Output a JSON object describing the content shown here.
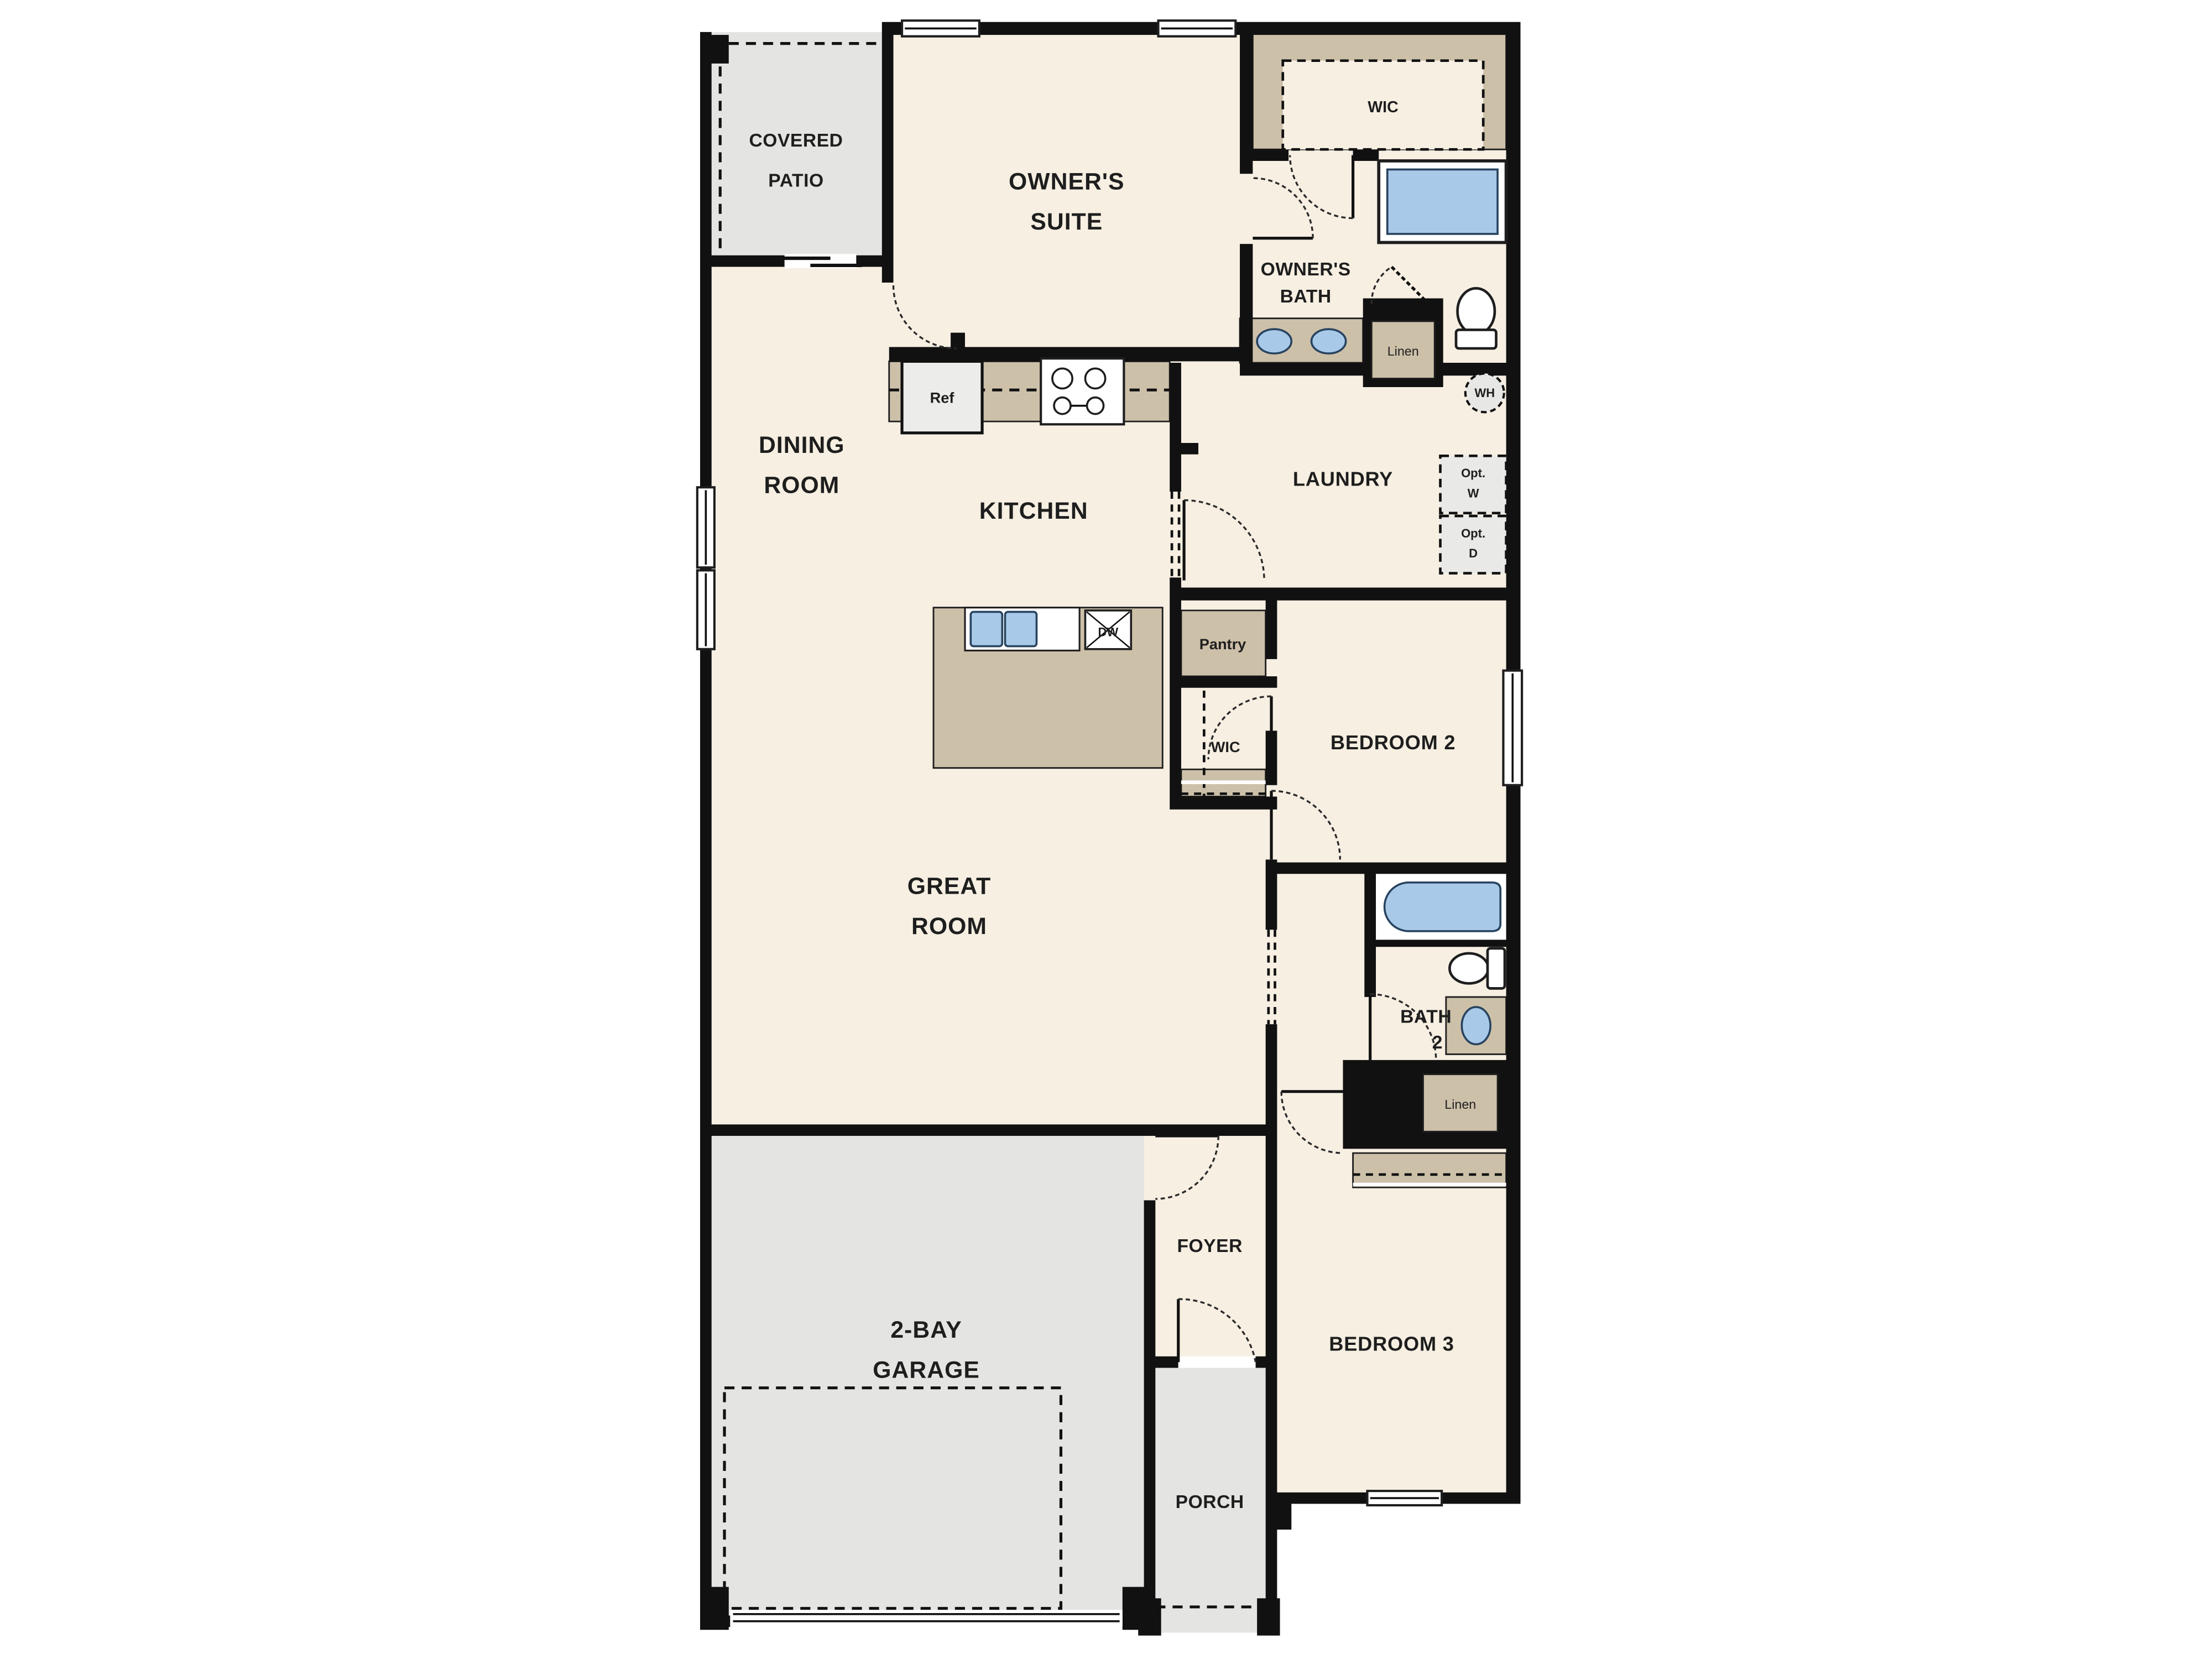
{
  "plan_type": "single-story house floor plan",
  "colors": {
    "background": "#ffffff",
    "room_fill": "#f6efe2",
    "cabinet_tan": "#cdc0a9",
    "outdoor_gray": "#e4e4e2",
    "fixture_blue": "#a9c9e8",
    "wall_black": "#111111",
    "text": "#1e1e1e"
  },
  "rooms": {
    "covered_patio": {
      "line1": "COVERED",
      "line2": "PATIO"
    },
    "owners_suite": {
      "line1": "OWNER'S",
      "line2": "SUITE"
    },
    "wic_master": "WIC",
    "owners_bath": {
      "line1": "OWNER'S",
      "line2": "BATH"
    },
    "dining": {
      "line1": "DINING",
      "line2": "ROOM"
    },
    "kitchen": "KITCHEN",
    "laundry": "LAUNDRY",
    "pantry": "Pantry",
    "wic_hall": "WIC",
    "bedroom2": "BEDROOM 2",
    "great_room": {
      "line1": "GREAT",
      "line2": "ROOM"
    },
    "bath2": {
      "line1": "BATH",
      "line2": "2"
    },
    "foyer": "FOYER",
    "garage": {
      "line1": "2-BAY",
      "line2": "GARAGE"
    },
    "porch": "PORCH",
    "bedroom3": "BEDROOM 3"
  },
  "fixtures": {
    "ref": "Ref",
    "dw": "DW",
    "wh": "WH",
    "linen_owner": "Linen",
    "linen_bath2": "Linen",
    "opt_w": {
      "line1": "Opt.",
      "line2": "W"
    },
    "opt_d": {
      "line1": "Opt.",
      "line2": "D"
    }
  }
}
